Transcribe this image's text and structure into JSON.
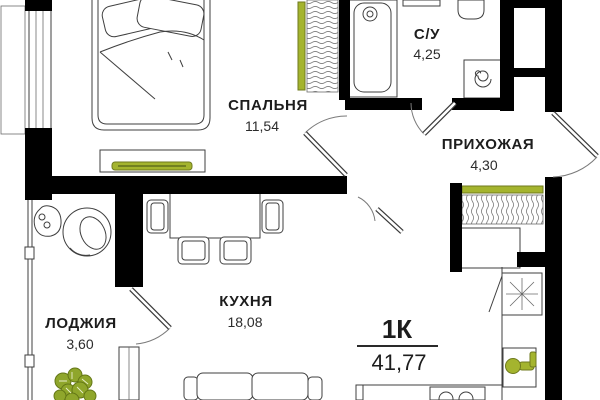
{
  "plan": {
    "title": "Floor plan — 1-room apartment",
    "apartment": {
      "type_label": "1К",
      "total_area": "41,77"
    },
    "rooms": {
      "bedroom": {
        "name": "СПАЛЬНЯ",
        "area": "11,54"
      },
      "bathroom": {
        "name": "С/У",
        "area": "4,25"
      },
      "hallway": {
        "name": "ПРИХОЖАЯ",
        "area": "4,30"
      },
      "kitchen": {
        "name": "КУХНЯ",
        "area": "18,08"
      },
      "loggia": {
        "name": "ЛОДЖИЯ",
        "area": "3,60"
      }
    },
    "colors": {
      "walls": "#000000",
      "furniture_line": "#3f3f3f",
      "accent_green": "#a4b42e",
      "plant_green": "#8fa62b",
      "text": "#1d1d1d",
      "background": "#ffffff"
    },
    "fixtures": [
      "bed",
      "bedroom-wardrobe",
      "tv-stand",
      "bathtub",
      "toilet",
      "washing-machine",
      "ventilation-shaft",
      "entrance-door",
      "hallway-wardrobe",
      "hallway-cabinet",
      "dining-table",
      "chairs",
      "sofa",
      "kitchen-counter",
      "fridge",
      "kitchen-sink",
      "hob",
      "armchair",
      "side-table",
      "plant"
    ]
  }
}
